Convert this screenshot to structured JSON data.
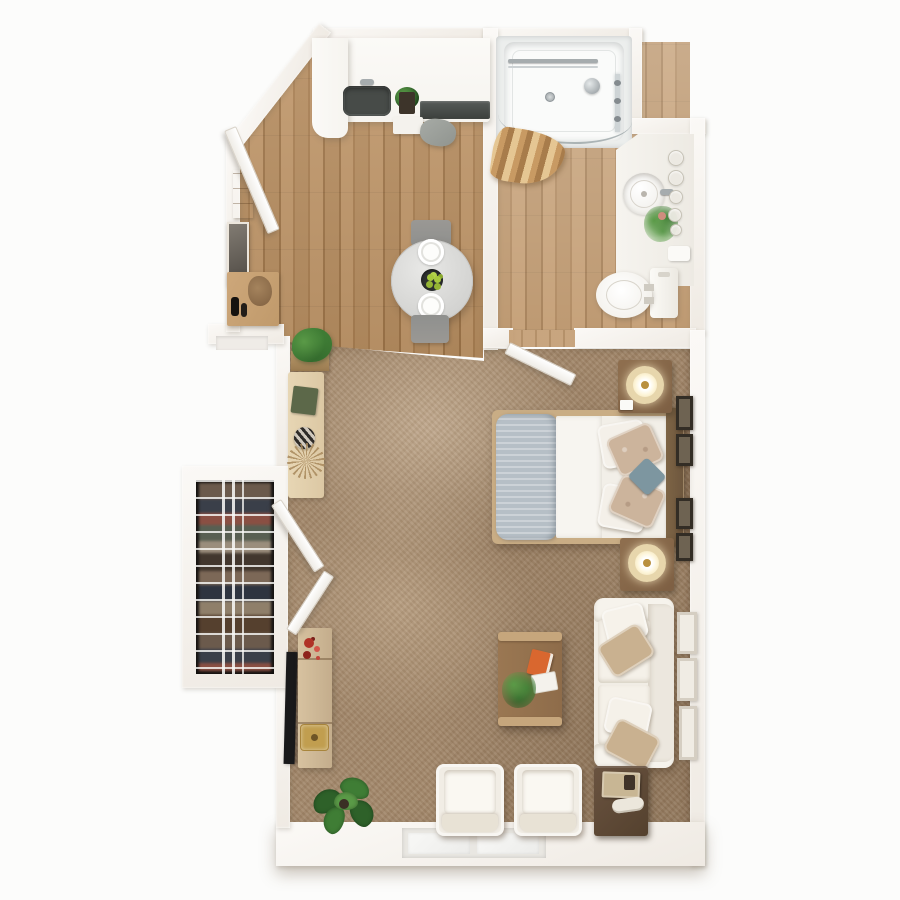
{
  "meta": {
    "title": "Studio apartment - photorealistic 3D top-down floor plan",
    "view": "top-down 3D render",
    "text_on_image": "none"
  },
  "palette": {
    "white": "#fcfcfb",
    "wall": "#f5f1ea",
    "wood1": "#b58c5f",
    "wood2": "#a87e51",
    "wood3": "#bf9669",
    "wood4": "#9d7448",
    "carpet": "#a2876a",
    "cream": "#f1ede5",
    "cream2": "#e7e1d6",
    "counter": "#f6f4ef",
    "appl": "#474b48",
    "cooktop": "#3c403d",
    "steel": "#90948f",
    "woodfurn": "#7d5f43",
    "woodmid": "#8e6c4a",
    "woodlight": "#c9ad85",
    "bench": "#dcc8a4",
    "tvwood": "#c4ad8c",
    "darkwood": "#6e573e",
    "darker": "#54412e",
    "entrywood": "#c09a6b",
    "blanket": "#b6bfc6",
    "tanp": "#c9b190",
    "floral": "#ccb49c",
    "teal": "#7d96a0",
    "lampring": "#e7d6ac",
    "lampglow": "#fdf4d6",
    "lampdot": "#b9903f",
    "green1": "#2e6129",
    "green2": "#3f7d35",
    "green3": "#5a9a47",
    "lime": "#a6c83d",
    "bowl": "#2e3130",
    "orange": "#d9672f",
    "red": "#b03227",
    "gold": "#c19e4f",
    "metal": "#a6acae",
    "glass": "#ccd3d5",
    "closetbg": "#231f1c",
    "graychair": "#8f908e"
  },
  "rooms": {
    "entry": {
      "label": "Entry hall with angled front door, mirror and console"
    },
    "kitchen": {
      "label": "Kitchen with white counter, sink and cooktop"
    },
    "dining": {
      "label": "Dining area with round table for two"
    },
    "bathroom": {
      "label": "Bathroom with shower, vanity sink and toilet"
    },
    "closet": {
      "label": "Closet with hanging clothes and wire shelves"
    },
    "living": {
      "label": "Combined living and sleeping area on carpet"
    }
  },
  "furniture": {
    "kitchen_counter": {
      "label": "L-shaped kitchen counter"
    },
    "kitchen_sink": {
      "label": "Dark undermount kitchen sink"
    },
    "cooktop": {
      "label": "Dark cooktop strip"
    },
    "dishwasher": {
      "label": "Built-in appliance front"
    },
    "dining_table": {
      "label": "Round dining table with two place settings and fruit bowl"
    },
    "dining_chairs": {
      "label": "Two dining chairs with gray cushions"
    },
    "entry_door": {
      "label": "Entry door on angled wall, open"
    },
    "hall_mirror": {
      "label": "Entry mirror"
    },
    "entry_console": {
      "label": "Entry console with vases"
    },
    "closet_doors": {
      "label": "Two open closet doors"
    },
    "closet_clothes": {
      "label": "Hanging clothes behind wire shelving"
    },
    "console_bench": {
      "label": "Low console table with book and decor"
    },
    "corner_planter": {
      "label": "Boxed green plant at carpet edge"
    },
    "tv": {
      "label": "Flat TV facing the room"
    },
    "tv_console": {
      "label": "Media console with flowers and gold tray"
    },
    "floor_plant": {
      "label": "Large leafy floor plant"
    },
    "bed": {
      "label": "Double bed with gray folded blanket and patterned pillows"
    },
    "nightstands": {
      "label": "Two wooden nightstands with glowing round lamps"
    },
    "wall_frames_bed": {
      "label": "Dark picture frames beside bed"
    },
    "sofa": {
      "label": "White sofa with tan accent pillows"
    },
    "wall_frames_sofa": {
      "label": "Light picture frames beside sofa"
    },
    "coffee_table": {
      "label": "Wooden coffee table with orange book, notebook and plant"
    },
    "armchairs": {
      "label": "Two white cube armchairs"
    },
    "end_table": {
      "label": "Dark end table with books"
    },
    "shower": {
      "label": "Walk-in shower with curved glass and beige curtain"
    },
    "vanity": {
      "label": "Bathroom vanity with round sink, plant and toiletries"
    },
    "toilet": {
      "label": "Toilet with tank"
    },
    "window": {
      "label": "Double window in bottom wall"
    }
  }
}
